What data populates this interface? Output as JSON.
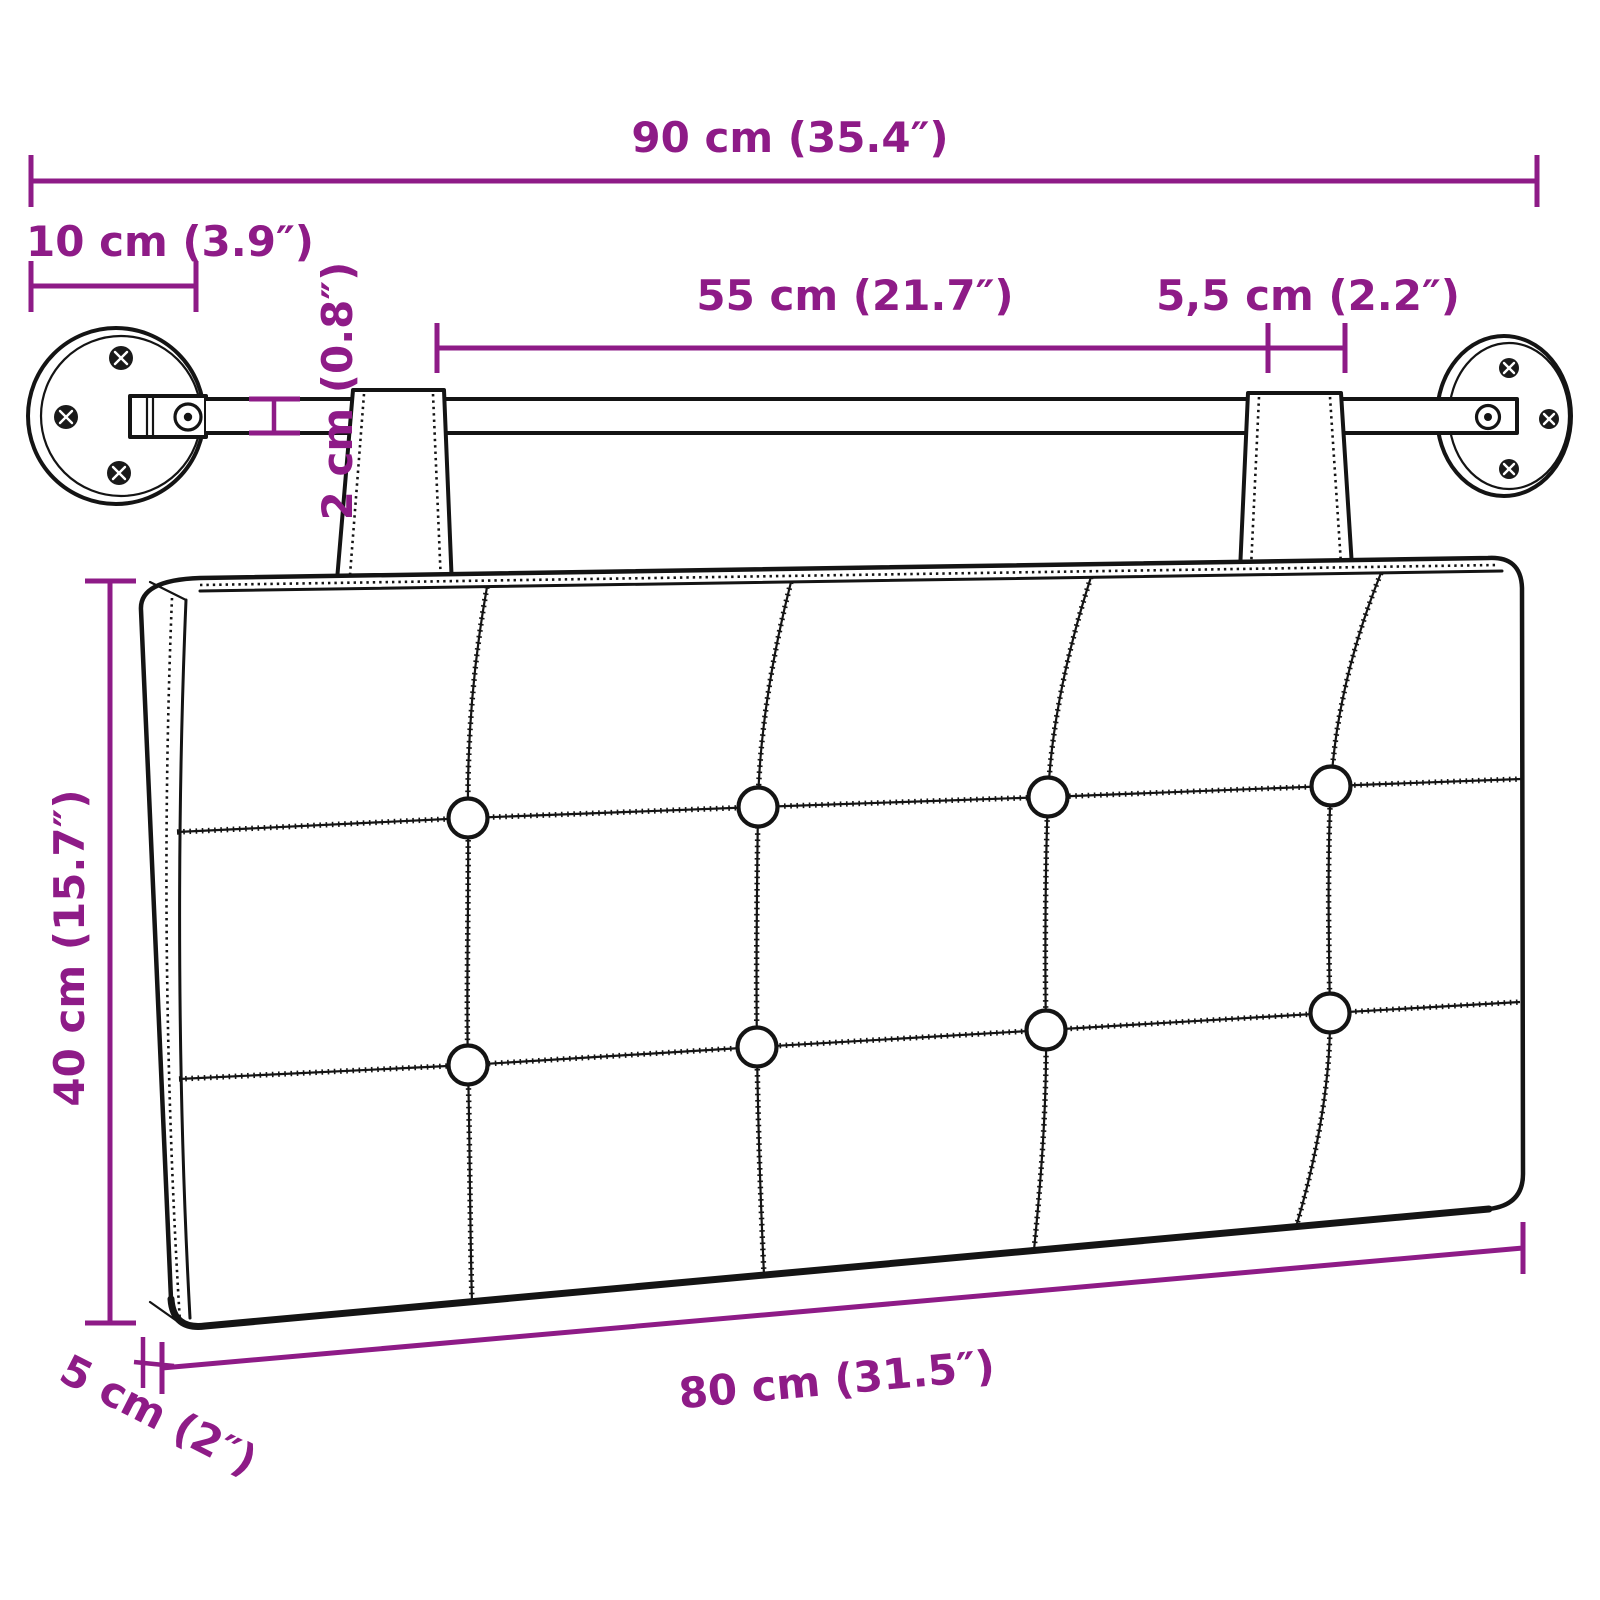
{
  "colors": {
    "dimension": "#8E1B87",
    "outline": "#141414",
    "background": "#ffffff"
  },
  "dimensions": {
    "total_width": {
      "label": "90 cm (35.4″)"
    },
    "mount_offset": {
      "label": "10 cm (3.9″)"
    },
    "strap_spacing": {
      "label": "55 cm (21.7″)"
    },
    "strap_width": {
      "label": "5,5 cm (2.2″)"
    },
    "rod_diameter": {
      "label": "2 cm (0.8″)"
    },
    "height": {
      "label": "40 cm (15.7″)"
    },
    "width_cushion": {
      "label": "80 cm (31.5″)"
    },
    "thickness": {
      "label": "5 cm (2″)"
    }
  }
}
